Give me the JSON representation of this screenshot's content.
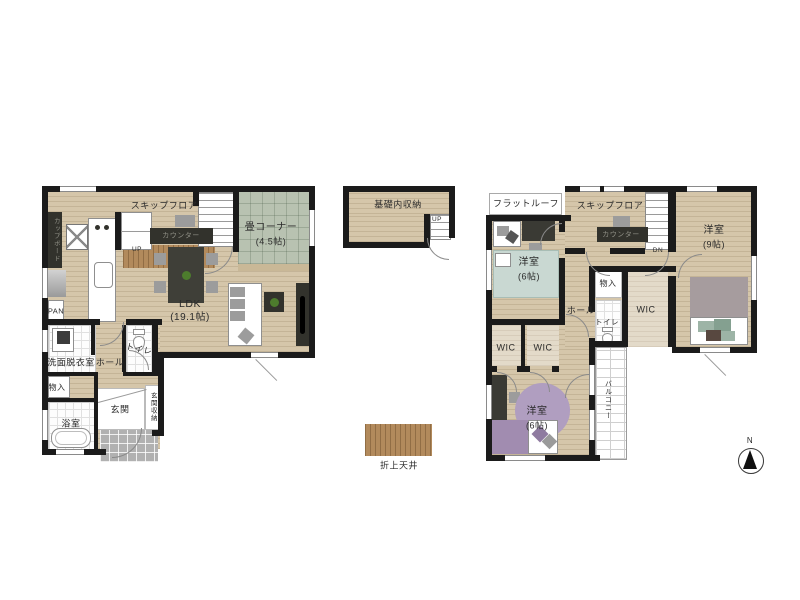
{
  "floor1": {
    "skip_floor": "スキップフロア",
    "counter": "カウンター",
    "up": "UP",
    "cupboard": "カップボード",
    "pantry": "PAN",
    "tatami": {
      "name": "畳コーナー",
      "size": "(4.5帖)"
    },
    "ldk": {
      "name": "LDK",
      "size": "(19.1帖)"
    },
    "washroom": "洗面脱衣室",
    "hall": "ホール",
    "toilet": "トイレ",
    "storage": "物入",
    "bath": "浴室",
    "entry": "玄関",
    "entry_storage": "玄関収納"
  },
  "basement": {
    "name": "基礎内収納",
    "up": "UP"
  },
  "floor2": {
    "flat_roof": "フラットルーフ",
    "skip_floor": "スキップフロア",
    "counter": "カウンター",
    "down": "DN",
    "bedroom_9": {
      "name": "洋室",
      "size": "(9帖)"
    },
    "bedroom_6_upper": {
      "name": "洋室",
      "size": "(6帖)"
    },
    "bedroom_6_lower": {
      "name": "洋室",
      "size": "(6帖)"
    },
    "storage": "物入",
    "hall": "ホール",
    "toilet": "トイレ",
    "wic_main": "WIC",
    "wic_left": "WIC",
    "wic_right": "WIC",
    "balcony": "バルコニー"
  },
  "legend": {
    "coffered_ceiling": "折上天井"
  },
  "compass": {
    "north": "N"
  },
  "colors": {
    "wall": "#1b1b1b",
    "floor": "#d5c6aa",
    "tatami": "#b8c2b1",
    "coffered": "#b28a5c",
    "bed_green": "#c9d8d2",
    "rug_purple": "#b09ec0",
    "furniture_dark": "#32322c"
  }
}
